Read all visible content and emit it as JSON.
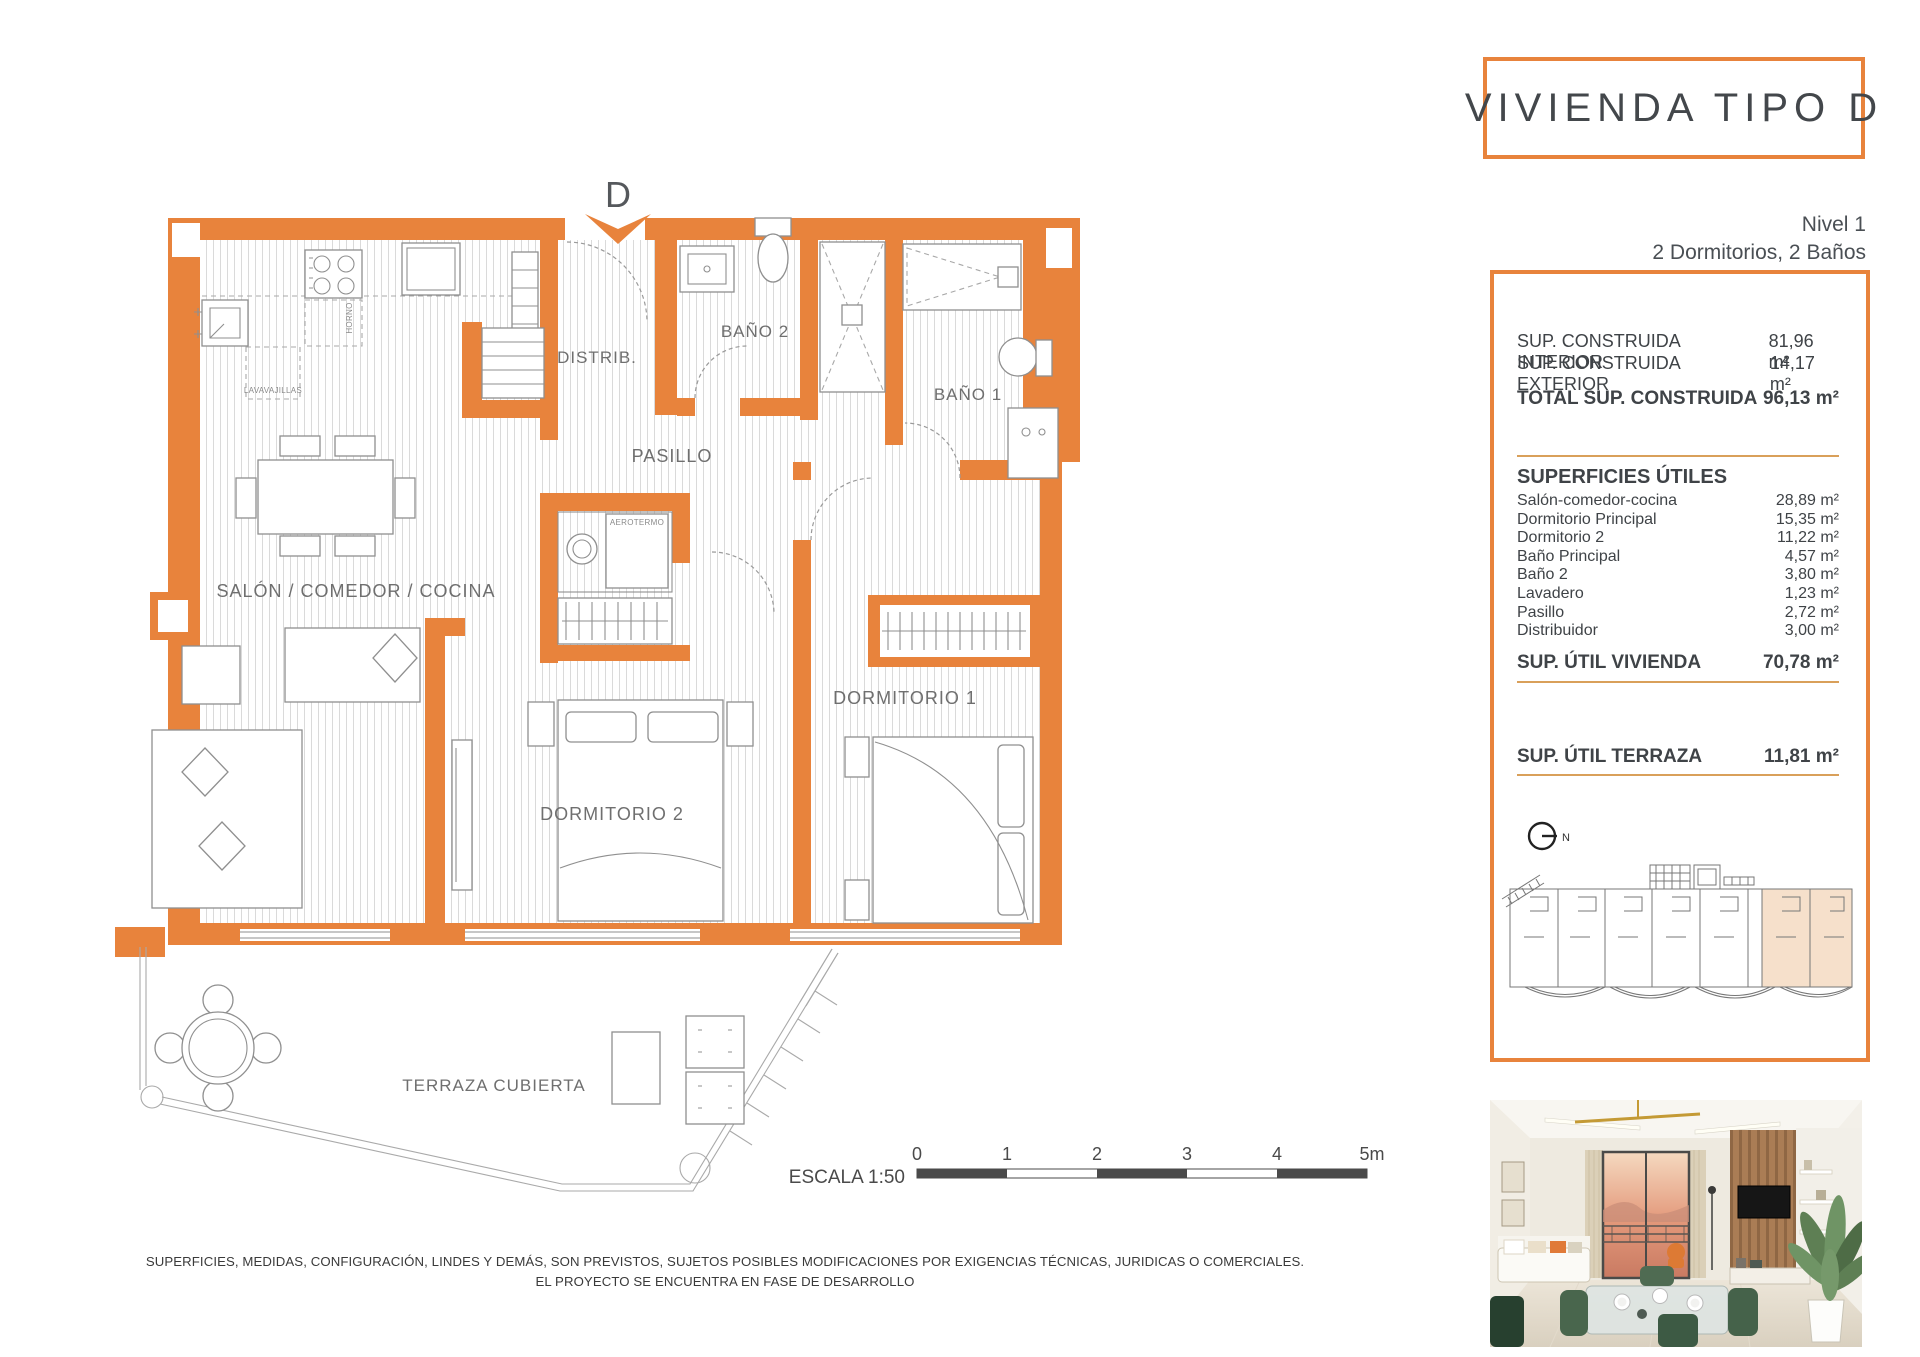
{
  "colors": {
    "accent": "#E8833C",
    "highlight": "#F6E0CB",
    "divider_tan": "#D9A05A",
    "title_text": "#43474B",
    "label_gray": "#6F6F6F"
  },
  "header": {
    "title": "VIVIENDA TIPO D",
    "level": "Nivel 1",
    "rooms_summary": "2 Dormitorios, 2 Baños"
  },
  "panel": {
    "construida": {
      "interior_label": "SUP. CONSTRUIDA INTERIOR",
      "interior_value": "81,96 m²",
      "exterior_label": "SUP. CONSTRUIDA EXTERIOR",
      "exterior_value": "14,17 m²",
      "total_label": "TOTAL SUP. CONSTRUIDA",
      "total_value": "96,13 m²"
    },
    "superficies": {
      "header": "SUPERFICIES ÚTILES",
      "items": [
        {
          "label": "Salón-comedor-cocina",
          "value": "28,89 m²"
        },
        {
          "label": "Dormitorio Principal",
          "value": "15,35 m²"
        },
        {
          "label": "Dormitorio 2",
          "value": "11,22 m²"
        },
        {
          "label": "Baño Principal",
          "value": "4,57 m²"
        },
        {
          "label": "Baño 2",
          "value": "3,80 m²"
        },
        {
          "label": "Lavadero",
          "value": "1,23 m²"
        },
        {
          "label": "Pasillo",
          "value": "2,72 m²"
        },
        {
          "label": "Distribuidor",
          "value": "3,00 m²"
        }
      ],
      "total_label": "SUP. ÚTIL VIVIENDA",
      "total_value": "70,78 m²"
    },
    "terraza": {
      "label": "SUP. ÚTIL TERRAZA",
      "value": "11,81 m²"
    },
    "compass_label": "N"
  },
  "plan": {
    "entry_label": "D",
    "rooms": {
      "salon": "SALÓN / COMEDOR / COCINA",
      "distrib": "DISTRIB.",
      "bano2": "BAÑO 2",
      "bano1": "BAÑO 1",
      "pasillo": "PASILLO",
      "dorm1": "DORMITORIO 1",
      "dorm2": "DORMITORIO 2",
      "terraza": "TERRAZA CUBIERTA"
    },
    "appliances": {
      "horno": "HORNO",
      "lavavajillas": "LAVAVAJILLAS",
      "aerotermo": "AEROTERMO"
    },
    "scale": {
      "label": "ESCALA 1:50",
      "ticks": [
        "0",
        "1",
        "2",
        "3",
        "4",
        "5m"
      ]
    }
  },
  "disclaimer": {
    "line1": "SUPERFICIES, MEDIDAS, CONFIGURACIÓN, LINDES Y DEMÁS, SON PREVISTOS, SUJETOS POSIBLES MODIFICACIONES POR EXIGENCIAS TÉCNICAS, JURIDICAS O COMERCIALES.",
    "line2": "EL PROYECTO SE ENCUENTRA EN FASE DE DESARROLLO"
  }
}
